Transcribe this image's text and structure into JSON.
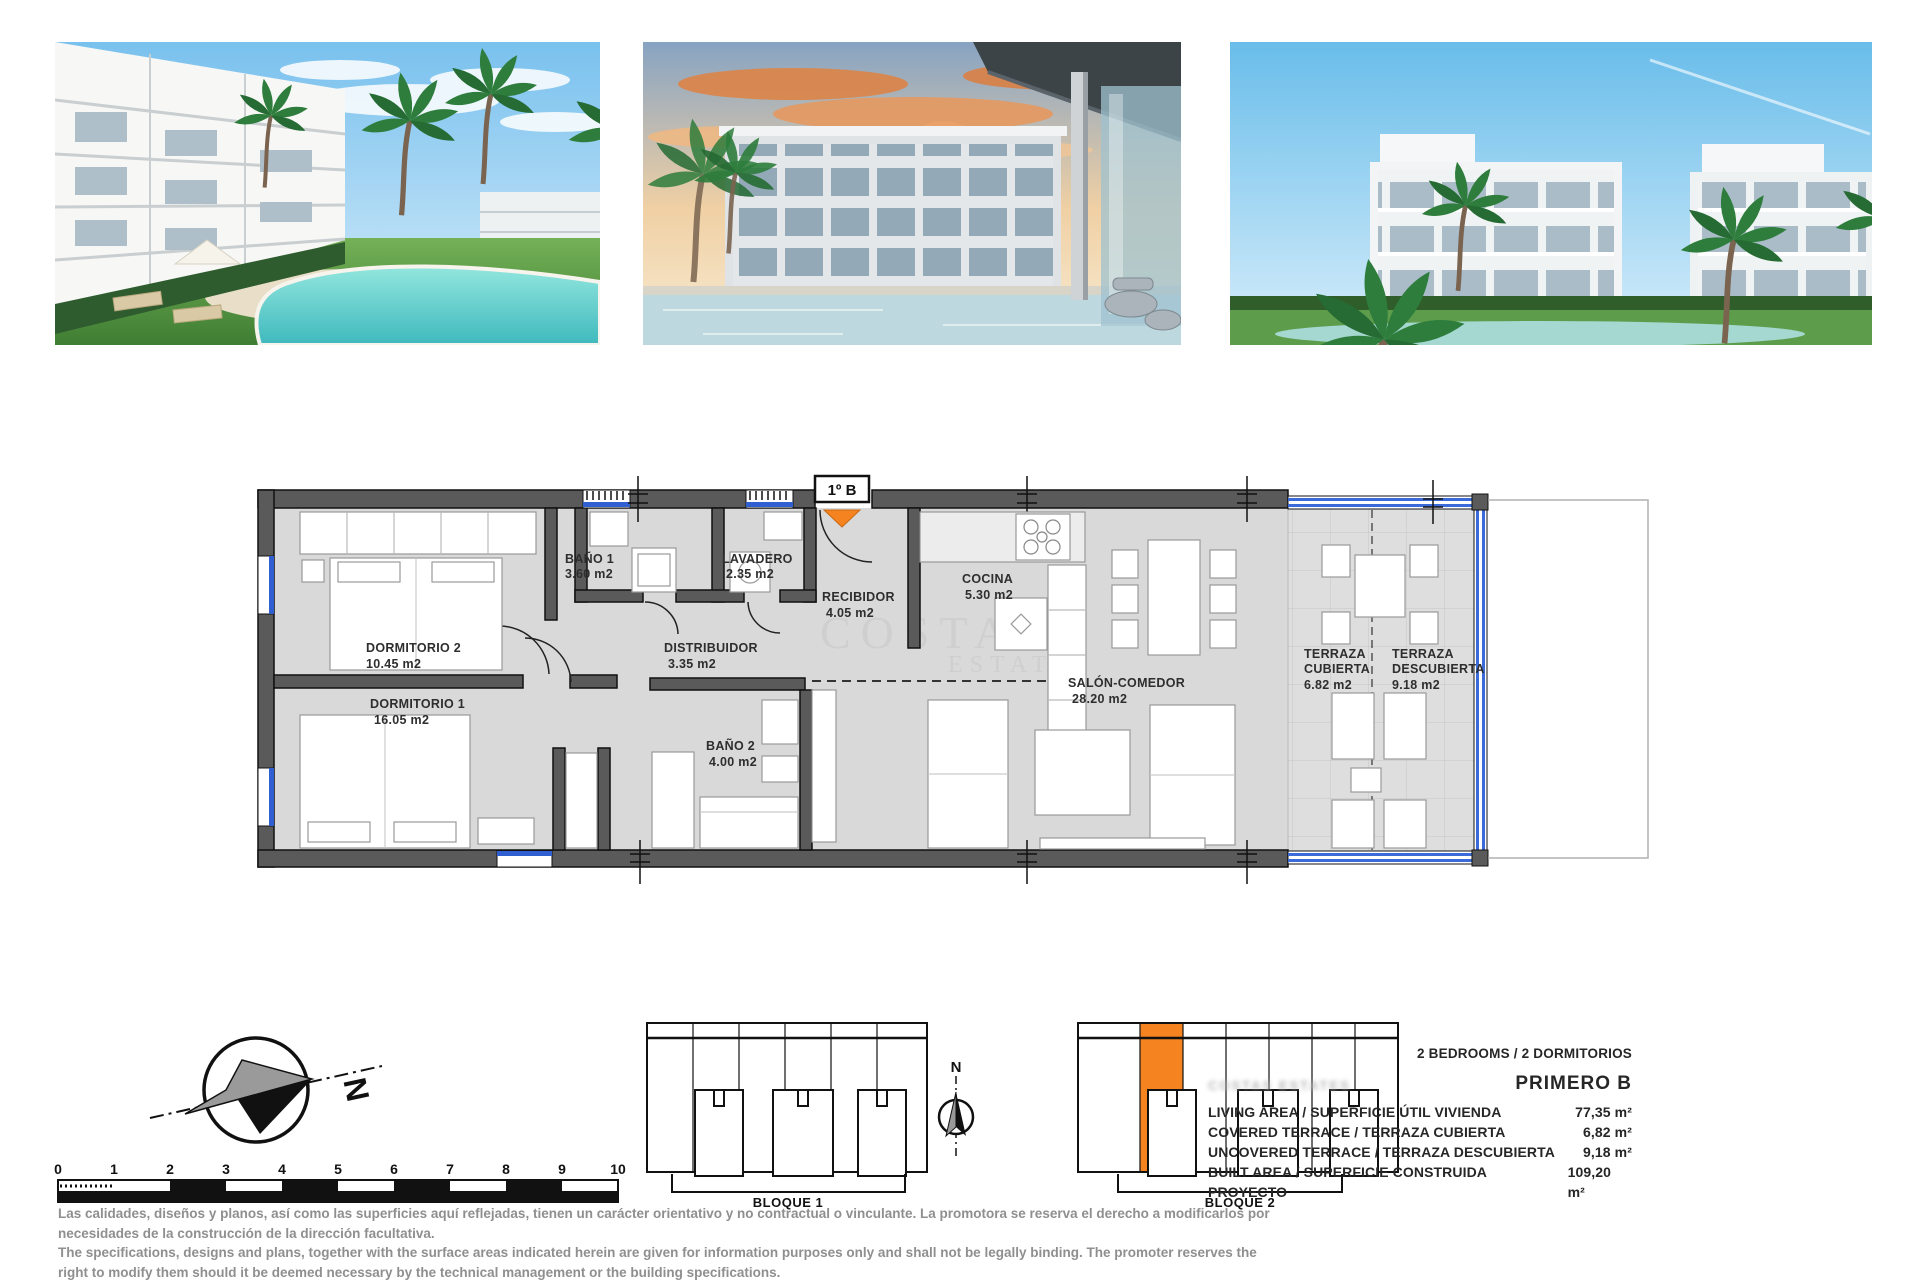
{
  "floorplan": {
    "unit_label": "1º B",
    "rooms": [
      {
        "name": "BAÑO 1",
        "area": "3.60 m2"
      },
      {
        "name": "LAVADERO",
        "area": "2.35 m2"
      },
      {
        "name": "RECIBIDOR",
        "area": "4.05 m2"
      },
      {
        "name": "COCINA",
        "area": "5.30 m2"
      },
      {
        "name": "DISTRIBUIDOR",
        "area": "3.35 m2"
      },
      {
        "name": "DORMITORIO 2",
        "area": "10.45 m2"
      },
      {
        "name": "DORMITORIO 1",
        "area": "16.05 m2"
      },
      {
        "name": "BAÑO 2",
        "area": "4.00 m2"
      },
      {
        "name": "SALÓN-COMEDOR",
        "area": "28.20 m2"
      },
      {
        "name_line1": "TERRAZA",
        "name_line2": "CUBIERTA",
        "area": "6.82 m2"
      },
      {
        "name_line1": "TERRAZA",
        "name_line2": "DESCUBIERTA",
        "area": "9.18 m2"
      }
    ],
    "watermark_line1": "COSTAS",
    "watermark_line2": "ESTATES",
    "accent_orange": "#F5831F",
    "window_blue": "#2f5fd0"
  },
  "site": {
    "north_label": "N",
    "north_label_small": "N",
    "scale_ticks": [
      "0",
      "1",
      "2",
      "3",
      "4",
      "5",
      "6",
      "7",
      "8",
      "9",
      "10"
    ],
    "bloque1_label": "BLOQUE 1",
    "bloque2_label": "BLOQUE 2",
    "highlight_color": "#F5831F"
  },
  "specs": {
    "bedrooms_line": "2 BEDROOMS / 2 DORMITORIOS",
    "unit_name": "PRIMERO B",
    "watermark": "COSTAS ESTATES",
    "rows": [
      {
        "label": "LIVING AREA / SUPERFICIE ÚTIL VIVIENDA",
        "value": "77,35 m²"
      },
      {
        "label": "COVERED TERRACE / TERRAZA CUBIERTA",
        "value": "6,82 m²"
      },
      {
        "label": "UNCOVERED TERRACE / TERRAZA DESCUBIERTA",
        "value": "9,18 m²"
      },
      {
        "label": "BUILT AREA / SUPERFICIE CONSTRUIDA PROYECTO",
        "value": "109,20 m²"
      }
    ]
  },
  "disclaimer": {
    "es_line1": "Las calidades, diseños y planos, así como las superficies aquí reflejadas, tienen un carácter orientativo y no contractual o vinculante. La promotora se reserva el derecho a modificarlos por",
    "es_line2": "necesidades de la construcción de la dirección facultativa.",
    "en_line1": "The specifications, designs and plans, together with the surface areas indicated herein are given for information purposes only and shall not be legally binding. The promoter reserves the",
    "en_line2": "right to modify them should it be deemed necessary by the technical management or the building specifications."
  }
}
